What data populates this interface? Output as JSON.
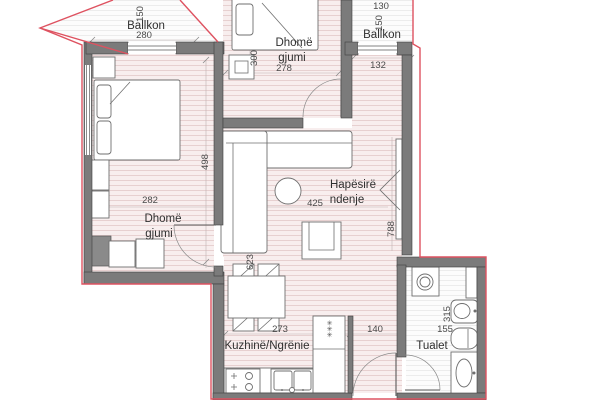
{
  "plan": {
    "rooms": {
      "balcony_left": {
        "label": "Ballkon",
        "depth": "150",
        "width": "280"
      },
      "bedroom_top": {
        "label1": "Dhomë",
        "label2": "gjumi",
        "width": "278",
        "height": "300"
      },
      "balcony_right": {
        "label": "Ballkon",
        "width": "130",
        "depth": "150"
      },
      "entry": {
        "width": "132"
      },
      "bedroom_left": {
        "label1": "Dhomë",
        "label2": "gjumi",
        "width": "282",
        "height": "498"
      },
      "living": {
        "label1": "Hapësirë",
        "label2": "ndenje",
        "width": "425",
        "height": "788"
      },
      "kitchen": {
        "label": "Kuzhinë/Ngrënie",
        "width": "273",
        "height": "623"
      },
      "hall": {
        "width": "140"
      },
      "toilet": {
        "label": "Tualet",
        "height": "315",
        "width": "155"
      }
    },
    "symbols": {
      "fridge_marks": "✳✳✳"
    },
    "colors": {
      "exterior_outline": "#de5260",
      "wall_fill": "#7b7b7b",
      "floor_tint": "#f8eeee",
      "floor_stripe": "#e7d0d0",
      "furniture_stroke": "#6f6f6f",
      "label_text": "#2f2f2f",
      "dimension_text": "#4a4a4a"
    }
  }
}
